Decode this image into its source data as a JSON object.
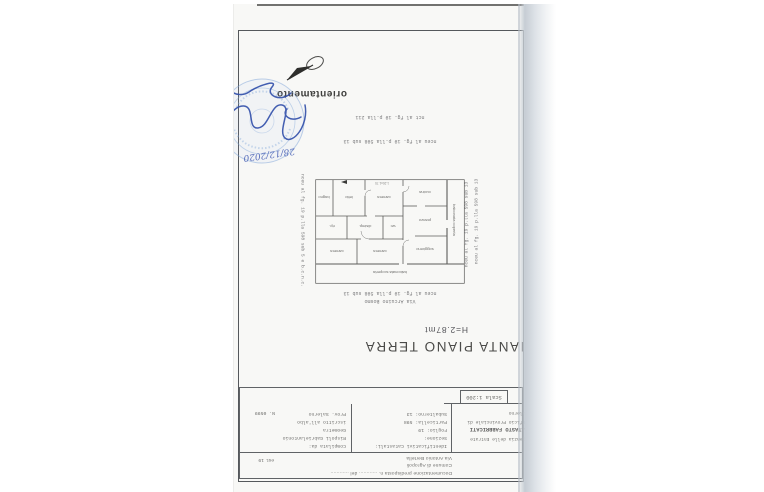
{
  "document": {
    "sheet_title": "PIANTA PIANO TERRA",
    "height_note": "H=2.87mt",
    "orientation_label": "orientamento",
    "scale_label": "Scala 1:200"
  },
  "title_block": {
    "row1_line1": "Documentazione predisposta n. ............ del ............",
    "row1_line2": "Comune di Agropoli",
    "row1_line3": "Via Antonio Bertella",
    "row1_right_note": "est. 19",
    "office_lines": [
      "Agenzia delle Entrate",
      "CATASTO FABBRICATI",
      "Ufficio Provinciale di",
      "Salerno"
    ],
    "cadastral_lines": [
      "Identificativi Catastali:",
      "Sezione:",
      "Foglio: 19",
      "Particella: 598",
      "Subalterno: 13"
    ],
    "compiler_lines": [
      "Compilata da:",
      "Rispoli Gabrielantonio",
      "Geometra",
      "iscritto all'albo",
      "Prov. Salerno"
    ],
    "compiler_number": "N. 0599"
  },
  "plan": {
    "street_label": "Via Arcuino Bosmo",
    "cadastral_caption": "nceu al fg. 19 p.lla 598 sub 13",
    "neighbor_below_1": "nceu al fg. 19 p.lla 598 sub 13",
    "neighbor_below_2": "nct al fg. 19 p.lla 211",
    "neighbor_side_right": "nceu al fg. 19 p.lla 598 sub 5 e b.c.n.c.",
    "neighbor_side_left_1": "nceu al fg. 19 p.lla 598 sub 13",
    "neighbor_side_left_2": "nceu al fg. 19 p.lla 598 sub 13",
    "balcony_top": "balconata scoperta",
    "balcony_left": "balconata coperta",
    "rooms": [
      "soggiorno",
      "pranzo",
      "cucina",
      "camera",
      "camera",
      "wc",
      "disimp.",
      "rip.",
      "camera",
      "letto",
      "bagno"
    ],
    "dim_note": "1.20x1.70"
  },
  "stamp": {
    "handwritten_date": "28/12/2020"
  },
  "colors": {
    "ink_blue": "#3b55b0",
    "stamp_blue": "#7da4d8",
    "line_gray": "#55585c",
    "paper": "#f8f8f6"
  }
}
